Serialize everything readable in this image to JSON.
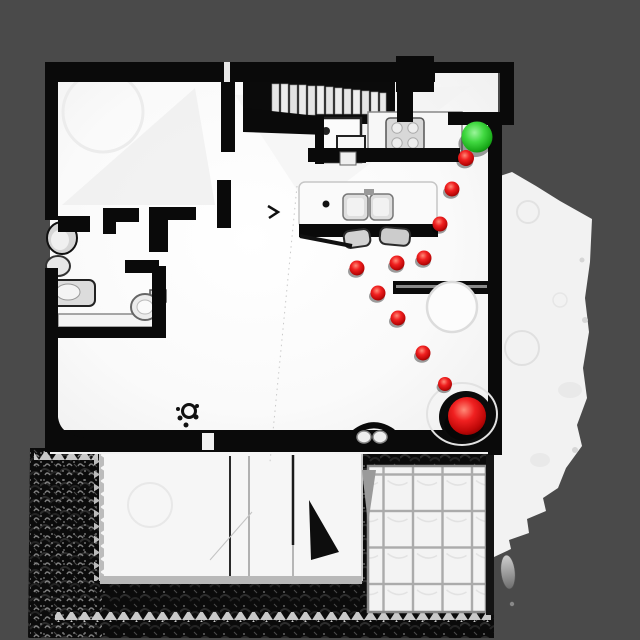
{
  "canvas": {
    "width": 640,
    "height": 640,
    "background_color": "#4a4a4a"
  },
  "palette": {
    "floor_white": "#f8f8f8",
    "wall_black": "#0a0a0a",
    "terrain_white": "#f2f2f2",
    "roof_dark": "#0b0b0b",
    "tile_grout": "#ababab",
    "goal_green": "#2ecc2e",
    "waypoint_red": "#dd1111",
    "start_red": "#e00808"
  },
  "markers": {
    "goal": {
      "kind": "goal-sphere",
      "x": 477,
      "y": 137,
      "r": 15.5,
      "color": "#2ecc2e"
    },
    "start": {
      "kind": "start-sphere",
      "x": 467,
      "y": 416,
      "r": 19,
      "color": "#e00808"
    },
    "waypoints": {
      "color": "#dd1111",
      "points": [
        {
          "x": 466,
          "y": 158,
          "r": 8.0
        },
        {
          "x": 452,
          "y": 189,
          "r": 7.5
        },
        {
          "x": 440,
          "y": 224,
          "r": 7.5
        },
        {
          "x": 424,
          "y": 258,
          "r": 7.5
        },
        {
          "x": 397,
          "y": 263,
          "r": 7.5
        },
        {
          "x": 357,
          "y": 268,
          "r": 7.5
        },
        {
          "x": 378,
          "y": 293,
          "r": 7.5
        },
        {
          "x": 398,
          "y": 318,
          "r": 7.5
        },
        {
          "x": 423,
          "y": 353,
          "r": 7.5
        },
        {
          "x": 445,
          "y": 384,
          "r": 7.0
        }
      ]
    }
  }
}
